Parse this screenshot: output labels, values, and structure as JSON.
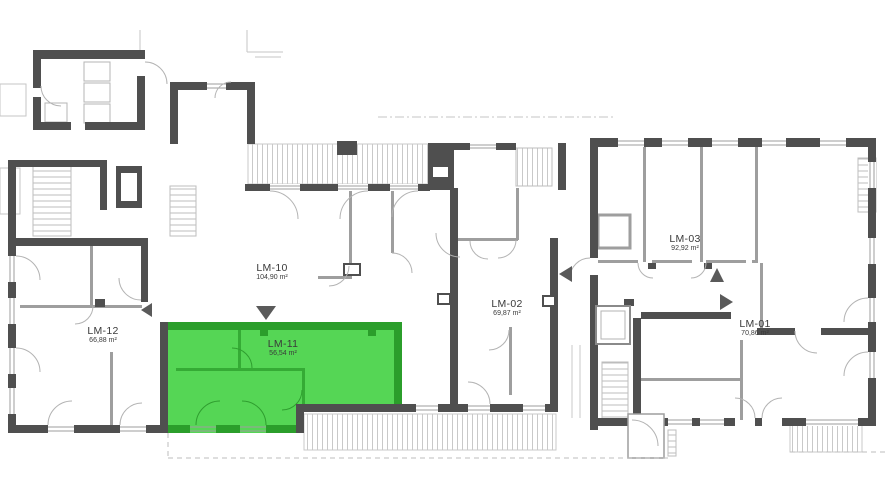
{
  "plan": {
    "type": "apartment-floor-plan",
    "units": [
      {
        "id": "lm-12",
        "label": "LM-12",
        "area": "66,88 m²",
        "highlighted": false
      },
      {
        "id": "lm-10",
        "label": "LM-10",
        "area": "104,90 m²",
        "highlighted": false
      },
      {
        "id": "lm-11",
        "label": "LM-11",
        "area": "56,54 m²",
        "highlighted": true
      },
      {
        "id": "lm-02",
        "label": "LM-02",
        "area": "69,87 m²",
        "highlighted": false
      },
      {
        "id": "lm-03",
        "label": "LM-03",
        "area": "92,92 m²",
        "highlighted": false
      },
      {
        "id": "lm-01",
        "label": "LM-01",
        "area": "70,86 m²",
        "highlighted": false
      }
    ],
    "colors": {
      "wall": "#4f4f4f",
      "partition": "#9e9e9e",
      "hatch": "#c9c9c9",
      "highlight_fill": "#55d655",
      "highlight_wall": "#2b9e2b",
      "highlight_partition": "#35ab35",
      "label_text": "#3a3a3a"
    }
  }
}
